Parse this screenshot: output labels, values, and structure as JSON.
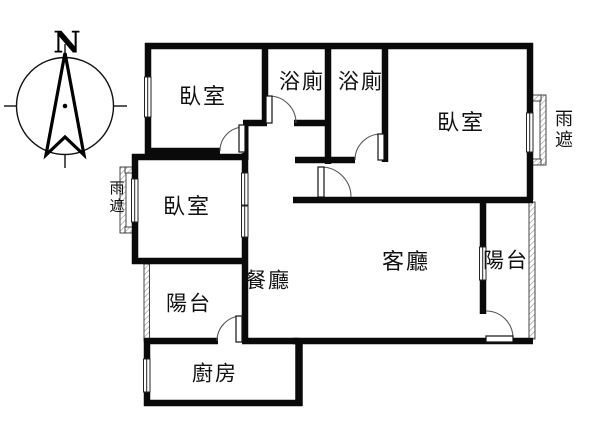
{
  "floor_plan": {
    "title": "apartment-floor-plan",
    "compass": {
      "letter": "N"
    },
    "colors": {
      "background": "#ffffff",
      "walls": "#0a0a0a",
      "thin_lines": "#333333",
      "hatch": "#999999",
      "text": "#111111"
    },
    "rooms": [
      {
        "id": "bedroom-top-left",
        "label": "臥室"
      },
      {
        "id": "bathroom-1",
        "label": "浴廁"
      },
      {
        "id": "bathroom-2",
        "label": "浴廁"
      },
      {
        "id": "bedroom-right",
        "label": "臥室"
      },
      {
        "id": "bedroom-left",
        "label": "臥室"
      },
      {
        "id": "dining-room",
        "label": "餐廳"
      },
      {
        "id": "living-room",
        "label": "客廳"
      },
      {
        "id": "balcony-left",
        "label": "陽台"
      },
      {
        "id": "balcony-right",
        "label": "陽台"
      },
      {
        "id": "kitchen",
        "label": "廚房"
      }
    ],
    "annotations": [
      {
        "id": "rain-shelter-left",
        "label": "雨遮",
        "orientation": "vertical"
      },
      {
        "id": "rain-shelter-right",
        "label": "雨遮",
        "orientation": "vertical"
      }
    ]
  }
}
